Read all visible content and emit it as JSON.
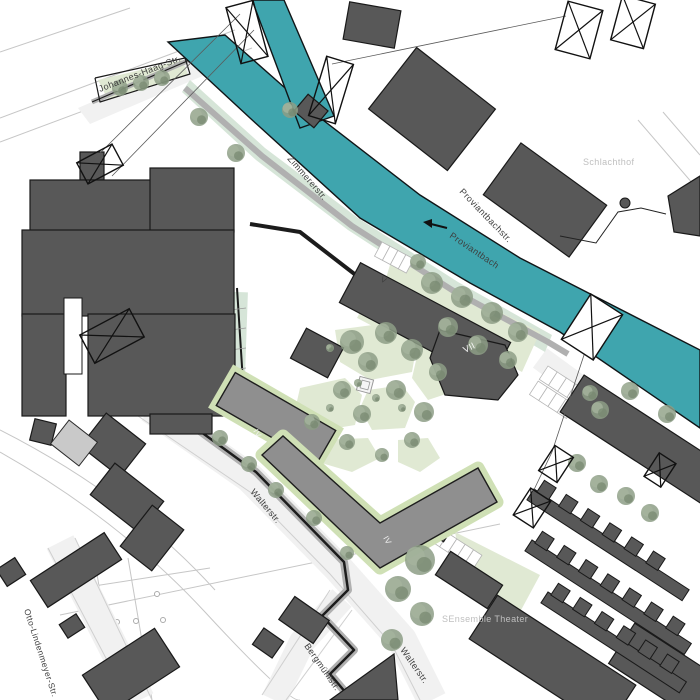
{
  "plan": {
    "colors": {
      "water": "#3fa5ae",
      "water_outline": "#101517",
      "building_dark": "#585858",
      "building_dark_stroke": "#191919",
      "building_new": "#8f8f8f",
      "building_new_stroke": "#1d1d1d",
      "building_light": "#c9c9c9",
      "green": "#e0e9d3",
      "sage": "#d6e5d8",
      "edging": "#cfe0b5",
      "street": "#f1f1f1",
      "casing": "#b0b0b0",
      "edge_line": "#cfcfcf",
      "thin_line": "#c6c6c6",
      "wire": "#5a5a5a",
      "tree": "#8d9d86",
      "tree_light": "#a5b49d",
      "tree_dark": "#76876f",
      "label_dark": "#3e3e3e",
      "label_light": "#bfbfbf",
      "white": "#ffffff"
    },
    "street_labels": [
      {
        "id": "johannes-haag-str",
        "text": "Johannes-Haag-Str.",
        "x": 100,
        "y": 92,
        "rot": -21,
        "tone": "dark",
        "size": 9
      },
      {
        "id": "zimmererstr",
        "text": "Zimmererstr.",
        "x": 287,
        "y": 159,
        "rot": 49,
        "tone": "dark",
        "size": 9
      },
      {
        "id": "proviantbachstr",
        "text": "Proviantbachstr.",
        "x": 459,
        "y": 192,
        "rot": 46,
        "tone": "dark",
        "size": 9
      },
      {
        "id": "proviantbach",
        "text": "Proviantbach",
        "x": 449,
        "y": 237,
        "rot": 34,
        "tone": "dark",
        "size": 9
      },
      {
        "id": "schlachthof",
        "text": "Schlachthof",
        "x": 583,
        "y": 165,
        "rot": 0,
        "tone": "light",
        "size": 9
      },
      {
        "id": "walterstr-upper",
        "text": "Walterstr.",
        "x": 250,
        "y": 492,
        "rot": 50,
        "tone": "dark",
        "size": 9
      },
      {
        "id": "walterstr-lower",
        "text": "Walterstr.",
        "x": 400,
        "y": 650,
        "rot": 55,
        "tone": "dark",
        "size": 9
      },
      {
        "id": "bergmuehlstr",
        "text": "Bergmühlstr.",
        "x": 304,
        "y": 646,
        "rot": 55,
        "tone": "dark",
        "size": 9
      },
      {
        "id": "otto-lindenmeyer-str",
        "text": "Otto-Lindenmeyer-Str.",
        "x": 24,
        "y": 610,
        "rot": 72,
        "tone": "dark",
        "size": 8.5
      },
      {
        "id": "sensemble-theater",
        "text": "SEnsemble Theater",
        "x": 442,
        "y": 622,
        "rot": 0,
        "tone": "light",
        "size": 9
      }
    ],
    "storey_labels": [
      {
        "text": "V",
        "x": 380,
        "y": 281,
        "rot": 28,
        "fill": "#3e3e3e",
        "size": 8
      },
      {
        "text": "VII",
        "x": 465,
        "y": 353,
        "rot": -27,
        "fill": "#f5f5f5",
        "size": 9
      },
      {
        "text": "IV",
        "x": 253,
        "y": 431,
        "rot": 60,
        "fill": "#f2f2f2",
        "size": 8
      },
      {
        "text": "IV",
        "x": 383,
        "y": 538,
        "rot": 60,
        "fill": "#f2f2f2",
        "size": 8
      }
    ],
    "water": [
      {
        "name": "canal-proviantbach",
        "pts": "225,35 310,110 420,195 520,258 700,350 700,428 560,332 470,283 360,218 250,118 168,42"
      },
      {
        "name": "canal-branch",
        "pts": "252,0 284,0 334,116 300,128"
      }
    ],
    "flow_arrow": {
      "x1": 447,
      "y1": 228,
      "x2": 423,
      "y2": 222
    },
    "greens": [
      {
        "type": "poly",
        "cls": "g",
        "pts": "98,80 182,60 188,74 108,100"
      },
      {
        "type": "poly",
        "cls": "sage",
        "pts": "190,80 265,148 358,218 458,282 552,335 545,352 448,295 348,230 256,160 182,92"
      },
      {
        "type": "poly",
        "cls": "g",
        "pts": "392,258 540,332 522,372 470,345 418,322 382,292"
      },
      {
        "type": "rect",
        "cls": "g",
        "x": 352,
        "y": 338,
        "w": 150,
        "h": 16,
        "rot": 28
      },
      {
        "type": "poly",
        "cls": "g",
        "pts": "335,330 395,322 418,338 412,372 370,380 340,362"
      },
      {
        "type": "poly",
        "cls": "g",
        "pts": "300,388 345,378 362,395 355,425 312,432 295,410"
      },
      {
        "type": "poly",
        "cls": "g",
        "pts": "368,390 402,385 415,402 405,428 372,430 360,408"
      },
      {
        "type": "poly",
        "cls": "g",
        "pts": "418,352 448,358 452,392 428,400 412,378"
      },
      {
        "type": "poly",
        "cls": "g",
        "pts": "322,440 368,438 380,458 352,472 318,462"
      },
      {
        "type": "poly",
        "cls": "g",
        "pts": "398,440 428,438 440,458 420,472 398,462"
      },
      {
        "type": "poly",
        "cls": "g",
        "pts": "455,532 540,575 520,612 462,568"
      },
      {
        "type": "rect",
        "cls": "sage",
        "x": 228,
        "y": 292,
        "w": 18,
        "h": 110,
        "rot": 2
      }
    ],
    "streets": [
      {
        "type": "poly",
        "pts": "78,108 228,44 240,60 90,124"
      },
      {
        "type": "band",
        "path": "M150,408 L250,478 L338,568 L402,640 L432,700",
        "w": 30
      },
      {
        "type": "band",
        "path": "M342,598 L302,642 L274,700",
        "w": 26
      },
      {
        "type": "band",
        "path": "M60,542 L140,700",
        "w": 30
      },
      {
        "type": "band",
        "path": "M540,358 L700,475",
        "w": 24
      }
    ],
    "street_edges": [
      "M138,416 L250,492 L330,574 L392,645 L420,700",
      "M48,548 L128,700",
      "M75,538 L152,700",
      "M330,590 L262,695",
      "M352,610 L286,700"
    ],
    "walls": [
      {
        "path": "M160,402 L256,472 L344,562 L348,590 L322,616 L354,650 L330,674 L352,700",
        "casing": 8,
        "line": 2.5
      },
      {
        "path": "M185,88 L262,156 L352,226 L452,290 L548,342 L568,354",
        "casing": 6,
        "line": 0
      },
      {
        "path": "M250,224 L300,232 L370,286",
        "casing": 0,
        "line": 4
      },
      {
        "path": "M237,288 L244,398 L234,404",
        "casing": 0,
        "line": 2
      },
      {
        "path": "M92,102 L185,62 L225,42",
        "casing": 5,
        "line": 1.2
      },
      {
        "path": "M95,78 L185,58 L190,74 L100,102 L95,78",
        "casing": 0,
        "line": 1.2
      }
    ],
    "thin_lines": [
      [
        0,
        118,
        235,
        30
      ],
      [
        0,
        142,
        252,
        48
      ],
      [
        0,
        52,
        130,
        8
      ],
      [
        638,
        120,
        700,
        192
      ],
      [
        663,
        112,
        700,
        155
      ],
      [
        540,
        362,
        698,
        480
      ],
      [
        60,
        615,
        500,
        524
      ],
      [
        55,
        592,
        210,
        568
      ],
      [
        95,
        562,
        118,
        700
      ],
      [
        128,
        558,
        152,
        700
      ]
    ],
    "curves": [
      "M0,452 Q120,520 205,612 T300,700",
      "M0,430 Q130,496 215,590"
    ],
    "nodes": [
      [
        117,
        622
      ],
      [
        136,
        621
      ],
      [
        163,
        620
      ],
      [
        157,
        594
      ]
    ],
    "fence": {
      "path": "560,236 596,243 618,212 641,208 666,214",
      "blob": [
        625,
        203
      ]
    },
    "buildings_dark": [
      {
        "type": "rect",
        "x": 80,
        "y": 152,
        "w": 24,
        "h": 28,
        "rot": 0
      },
      {
        "type": "rect",
        "x": 30,
        "y": 180,
        "w": 138,
        "h": 52,
        "rot": 0
      },
      {
        "type": "rect",
        "x": 150,
        "y": 168,
        "w": 84,
        "h": 64,
        "rot": 0
      },
      {
        "type": "rect",
        "x": 22,
        "y": 230,
        "w": 212,
        "h": 86,
        "rot": 0
      },
      {
        "type": "rect",
        "x": 88,
        "y": 314,
        "w": 147,
        "h": 102,
        "rot": 0
      },
      {
        "type": "rect",
        "x": 22,
        "y": 314,
        "w": 44,
        "h": 102,
        "rot": 0
      },
      {
        "type": "rect",
        "x": 150,
        "y": 414,
        "w": 62,
        "h": 20,
        "rot": 0
      },
      {
        "type": "rect",
        "x": 32,
        "y": 421,
        "w": 22,
        "h": 22,
        "rot": 14
      },
      {
        "type": "rect",
        "x": 88,
        "y": 424,
        "w": 50,
        "h": 42,
        "rot": 38
      },
      {
        "type": "rect",
        "x": 346,
        "y": 6,
        "w": 52,
        "h": 38,
        "rot": 10
      },
      {
        "type": "rect",
        "x": 382,
        "y": 70,
        "w": 100,
        "h": 78,
        "rot": 38
      },
      {
        "type": "rect",
        "x": 492,
        "y": 168,
        "w": 106,
        "h": 64,
        "rot": 36
      },
      {
        "type": "poly",
        "pts": "668,196 700,176 700,236 674,232"
      },
      {
        "type": "rect",
        "x": 298,
        "y": 100,
        "w": 26,
        "h": 22,
        "rot": 40
      },
      {
        "type": "rect",
        "x": 340,
        "y": 300,
        "w": 170,
        "h": 45,
        "rot": 28
      },
      {
        "type": "poly",
        "round": true,
        "pts": "440,330 505,345 518,375 498,400 445,395 430,358"
      },
      {
        "type": "rect",
        "x": 296,
        "y": 336,
        "w": 42,
        "h": 34,
        "rot": 28
      },
      {
        "type": "rect",
        "x": 556,
        "y": 426,
        "w": 200,
        "h": 44,
        "rot": 33
      },
      {
        "type": "rect",
        "x": 438,
        "y": 566,
        "w": 62,
        "h": 28,
        "rot": 33
      },
      {
        "type": "rect",
        "x": 424,
        "y": 520,
        "w": 26,
        "h": 16,
        "rot": 33
      },
      {
        "type": "rect",
        "x": 470,
        "y": 636,
        "w": 165,
        "h": 52,
        "rot": 33
      },
      {
        "type": "rect",
        "x": 612,
        "y": 652,
        "w": 120,
        "h": 48,
        "rot": 33
      },
      {
        "type": "poly",
        "pts": "330,700 398,700 394,654"
      },
      {
        "type": "rect",
        "x": 283,
        "y": 606,
        "w": 42,
        "h": 28,
        "rot": 35
      },
      {
        "type": "rect",
        "x": 256,
        "y": 633,
        "w": 24,
        "h": 20,
        "rot": 35
      },
      {
        "type": "rect",
        "x": 96,
        "y": 478,
        "w": 62,
        "h": 40,
        "rot": 38
      },
      {
        "type": "rect",
        "x": 132,
        "y": 512,
        "w": 40,
        "h": 52,
        "rot": 38
      },
      {
        "type": "rect",
        "x": 32,
        "y": 554,
        "w": 88,
        "h": 32,
        "rot": -33
      },
      {
        "type": "rect",
        "x": 62,
        "y": 618,
        "w": 20,
        "h": 16,
        "rot": -33
      },
      {
        "type": "rect",
        "x": 88,
        "y": 648,
        "w": 86,
        "h": 46,
        "rot": -33
      },
      {
        "type": "rect",
        "x": 0,
        "y": 562,
        "w": 22,
        "h": 20,
        "rot": -33
      }
    ],
    "comb_rows": [
      {
        "x": 534,
        "y": 489,
        "len": 185,
        "rot": 33
      },
      {
        "x": 532,
        "y": 540,
        "len": 190,
        "rot": 33
      },
      {
        "x": 548,
        "y": 592,
        "len": 165,
        "rot": 33
      }
    ],
    "buildings_new": [
      {
        "type": "rect",
        "x": 218,
        "y": 399,
        "w": 116,
        "h": 38,
        "rot": 30
      },
      {
        "type": "poly",
        "pts": "262,455 283,436 380,523 478,468 497,502 380,568"
      }
    ],
    "buildings_light": [
      {
        "type": "rect",
        "x": 56,
        "y": 428,
        "w": 36,
        "h": 30,
        "rot": 38
      }
    ],
    "courtyard_cuts": [
      {
        "type": "rect",
        "x": 64,
        "y": 298,
        "w": 18,
        "h": 76,
        "rot": 0
      }
    ],
    "trees": [
      [
        120,
        88,
        8
      ],
      [
        141,
        83,
        8
      ],
      [
        162,
        78,
        8
      ],
      [
        199,
        117,
        9
      ],
      [
        236,
        153,
        9
      ],
      [
        290,
        110,
        8
      ],
      [
        432,
        283,
        11
      ],
      [
        462,
        297,
        11
      ],
      [
        492,
        313,
        11
      ],
      [
        518,
        332,
        10
      ],
      [
        448,
        327,
        10
      ],
      [
        478,
        345,
        10
      ],
      [
        508,
        360,
        9
      ],
      [
        418,
        262,
        8
      ],
      [
        352,
        342,
        12
      ],
      [
        386,
        333,
        11
      ],
      [
        412,
        350,
        11
      ],
      [
        368,
        362,
        10
      ],
      [
        342,
        390,
        9
      ],
      [
        396,
        390,
        10
      ],
      [
        362,
        414,
        9
      ],
      [
        424,
        412,
        10
      ],
      [
        312,
        422,
        8
      ],
      [
        347,
        442,
        8
      ],
      [
        412,
        440,
        8
      ],
      [
        382,
        455,
        7
      ],
      [
        438,
        372,
        9
      ],
      [
        220,
        438,
        8
      ],
      [
        249,
        464,
        8
      ],
      [
        276,
        490,
        8
      ],
      [
        314,
        518,
        8
      ],
      [
        420,
        560,
        15
      ],
      [
        398,
        589,
        13
      ],
      [
        422,
        614,
        12
      ],
      [
        392,
        640,
        11
      ],
      [
        347,
        553,
        7
      ],
      [
        600,
        410,
        9
      ],
      [
        630,
        391,
        9
      ],
      [
        667,
        414,
        9
      ],
      [
        577,
        463,
        9
      ],
      [
        599,
        484,
        9
      ],
      [
        626,
        496,
        9
      ],
      [
        650,
        513,
        9
      ],
      [
        590,
        393,
        8
      ]
    ],
    "bushes": [
      [
        330,
        348,
        4
      ],
      [
        358,
        383,
        4
      ],
      [
        376,
        398,
        4
      ],
      [
        402,
        408,
        4
      ],
      [
        330,
        408,
        4
      ]
    ],
    "pylons": [
      {
        "x": 100,
        "y": 164,
        "w": 40,
        "h": 24,
        "rot": -28,
        "fill": "none"
      },
      {
        "x": 112,
        "y": 336,
        "w": 56,
        "h": 32,
        "rot": -28,
        "fill": "none"
      },
      {
        "x": 247,
        "y": 32,
        "w": 28,
        "h": 58,
        "rot": -15,
        "fill": "none"
      },
      {
        "x": 331,
        "y": 90,
        "w": 28,
        "h": 62,
        "rot": 17,
        "fill": "none"
      },
      {
        "x": 579,
        "y": 30,
        "w": 36,
        "h": 50,
        "rot": 15,
        "fill": "none"
      },
      {
        "x": 633,
        "y": 22,
        "w": 34,
        "h": 46,
        "rot": 15,
        "fill": "none"
      },
      {
        "x": 592,
        "y": 327,
        "w": 38,
        "h": 54,
        "rot": 33,
        "fill": "#ffffff"
      },
      {
        "x": 556,
        "y": 464,
        "w": 22,
        "h": 30,
        "rot": 33,
        "fill": "none"
      },
      {
        "x": 532,
        "y": 508,
        "w": 24,
        "h": 32,
        "rot": 33,
        "fill": "none"
      },
      {
        "x": 660,
        "y": 470,
        "w": 20,
        "h": 28,
        "rot": 33,
        "fill": "none"
      }
    ],
    "wires": [
      [
        95,
        158,
        240,
        14
      ],
      [
        112,
        176,
        254,
        30
      ],
      [
        332,
        64,
        566,
        16
      ],
      [
        585,
        352,
        552,
        452
      ],
      [
        552,
        452,
        531,
        496
      ]
    ],
    "parking": [
      {
        "x": 382,
        "y": 242,
        "rot": 28,
        "cols": 4,
        "rows": 1,
        "cw": 9,
        "ch": 16
      },
      {
        "x": 548,
        "y": 366,
        "rot": 33,
        "cols": 4,
        "rows": 2,
        "cw": 11,
        "ch": 16
      },
      {
        "x": 440,
        "y": 528,
        "rot": 33,
        "cols": 5,
        "rows": 1,
        "cw": 10,
        "ch": 16
      }
    ],
    "strip_ticks": [
      [
        230,
        310,
        246,
        308
      ],
      [
        230,
        330,
        246,
        328
      ],
      [
        230,
        350,
        246,
        348
      ],
      [
        230,
        370,
        246,
        368
      ]
    ],
    "square_feature": {
      "x": 365,
      "y": 385,
      "s1": 14,
      "s2": 8,
      "rot": 15
    }
  }
}
